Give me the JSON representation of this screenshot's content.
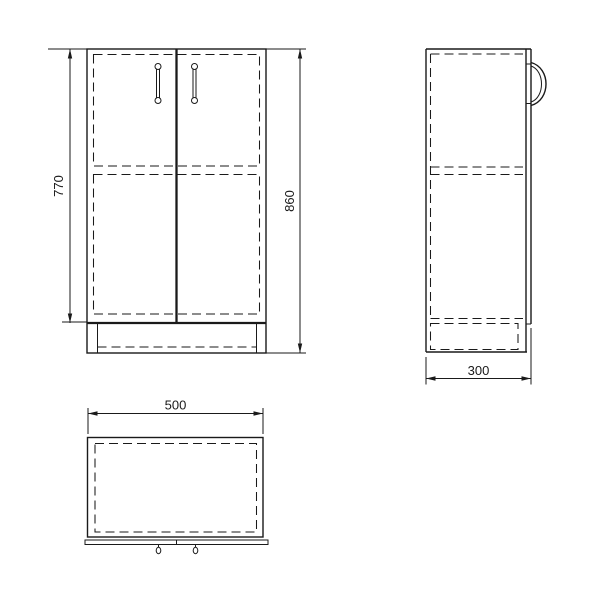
{
  "drawing": {
    "background": "#ffffff",
    "line_color": "#1a1a1a",
    "front_view": {
      "door_height_label": "770",
      "total_height_label": "860"
    },
    "side_view": {
      "depth_label": "300"
    },
    "top_view": {
      "width_label": "500"
    }
  }
}
